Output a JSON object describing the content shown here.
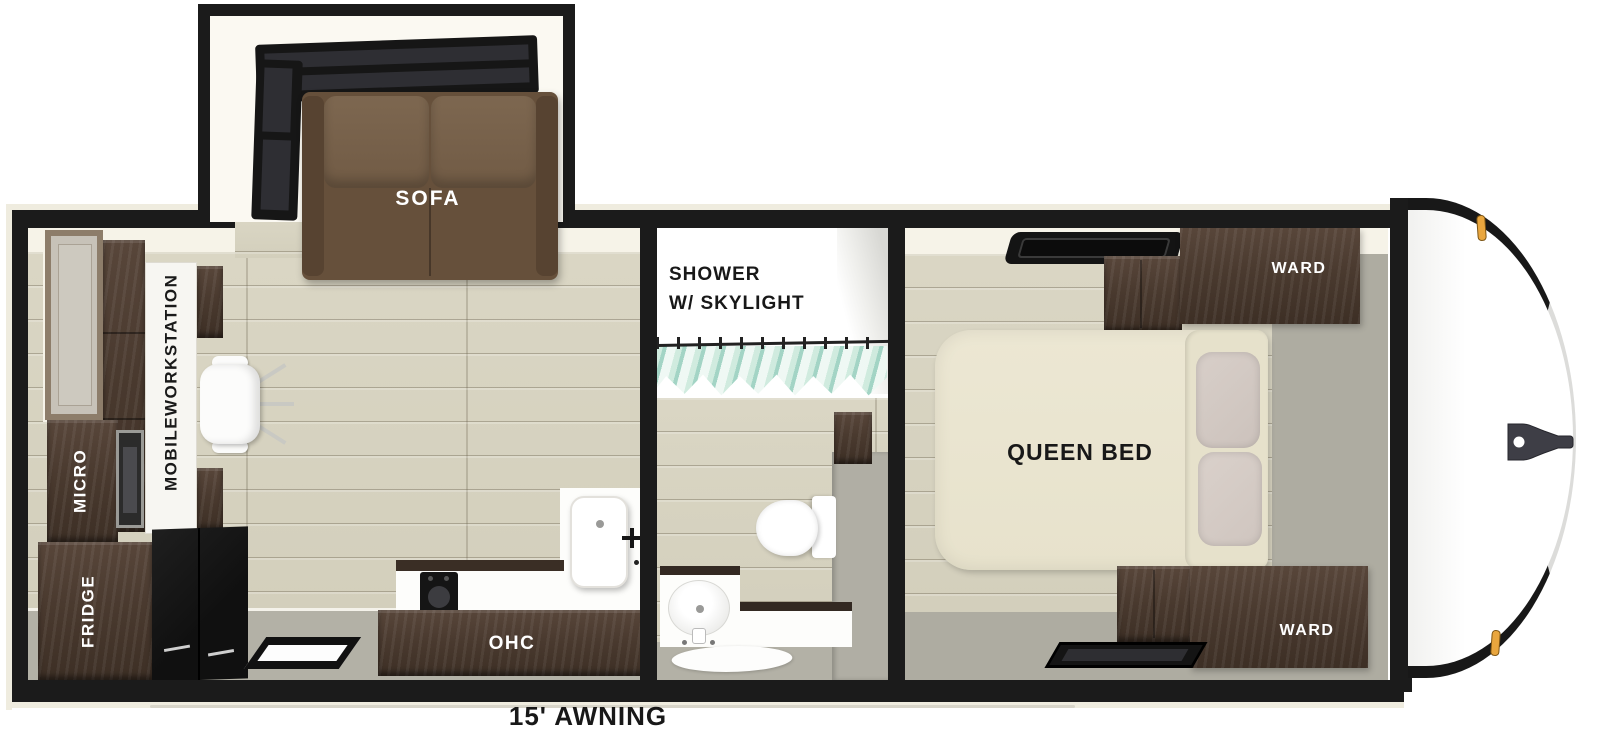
{
  "floorplan": {
    "slideout": {
      "sofa_label": "SOFA"
    },
    "living_area": {
      "workstation_label_line1": "MOBILE",
      "workstation_label_line2": "WORKSTATION",
      "micro_label": "MICRO",
      "fridge_label": "FRIDGE"
    },
    "kitchen": {
      "ohc_label": "OHC"
    },
    "bathroom": {
      "shower_label_line1": "SHOWER",
      "shower_label_line2": "W/ SKYLIGHT"
    },
    "bedroom": {
      "bed_label": "QUEEN BED",
      "ward_top_label": "WARD",
      "ward_bottom_label": "WARD"
    },
    "awning_label": "15' AWNING"
  },
  "colors": {
    "wall_black": "#1b1b1b",
    "wood_floor": "#d8d4c2",
    "gray_floor": "#b3b1a6",
    "interior_cream": "#f6f3e8",
    "cabinet_brown": "#4a3a2f",
    "sofa_brown": "#6e5741",
    "bed_cream": "#ebe6d2",
    "curtain_teal": "#a5d8c7",
    "marker_light_amber": "#e9a63e",
    "hitch_gray": "#3e3e46"
  }
}
